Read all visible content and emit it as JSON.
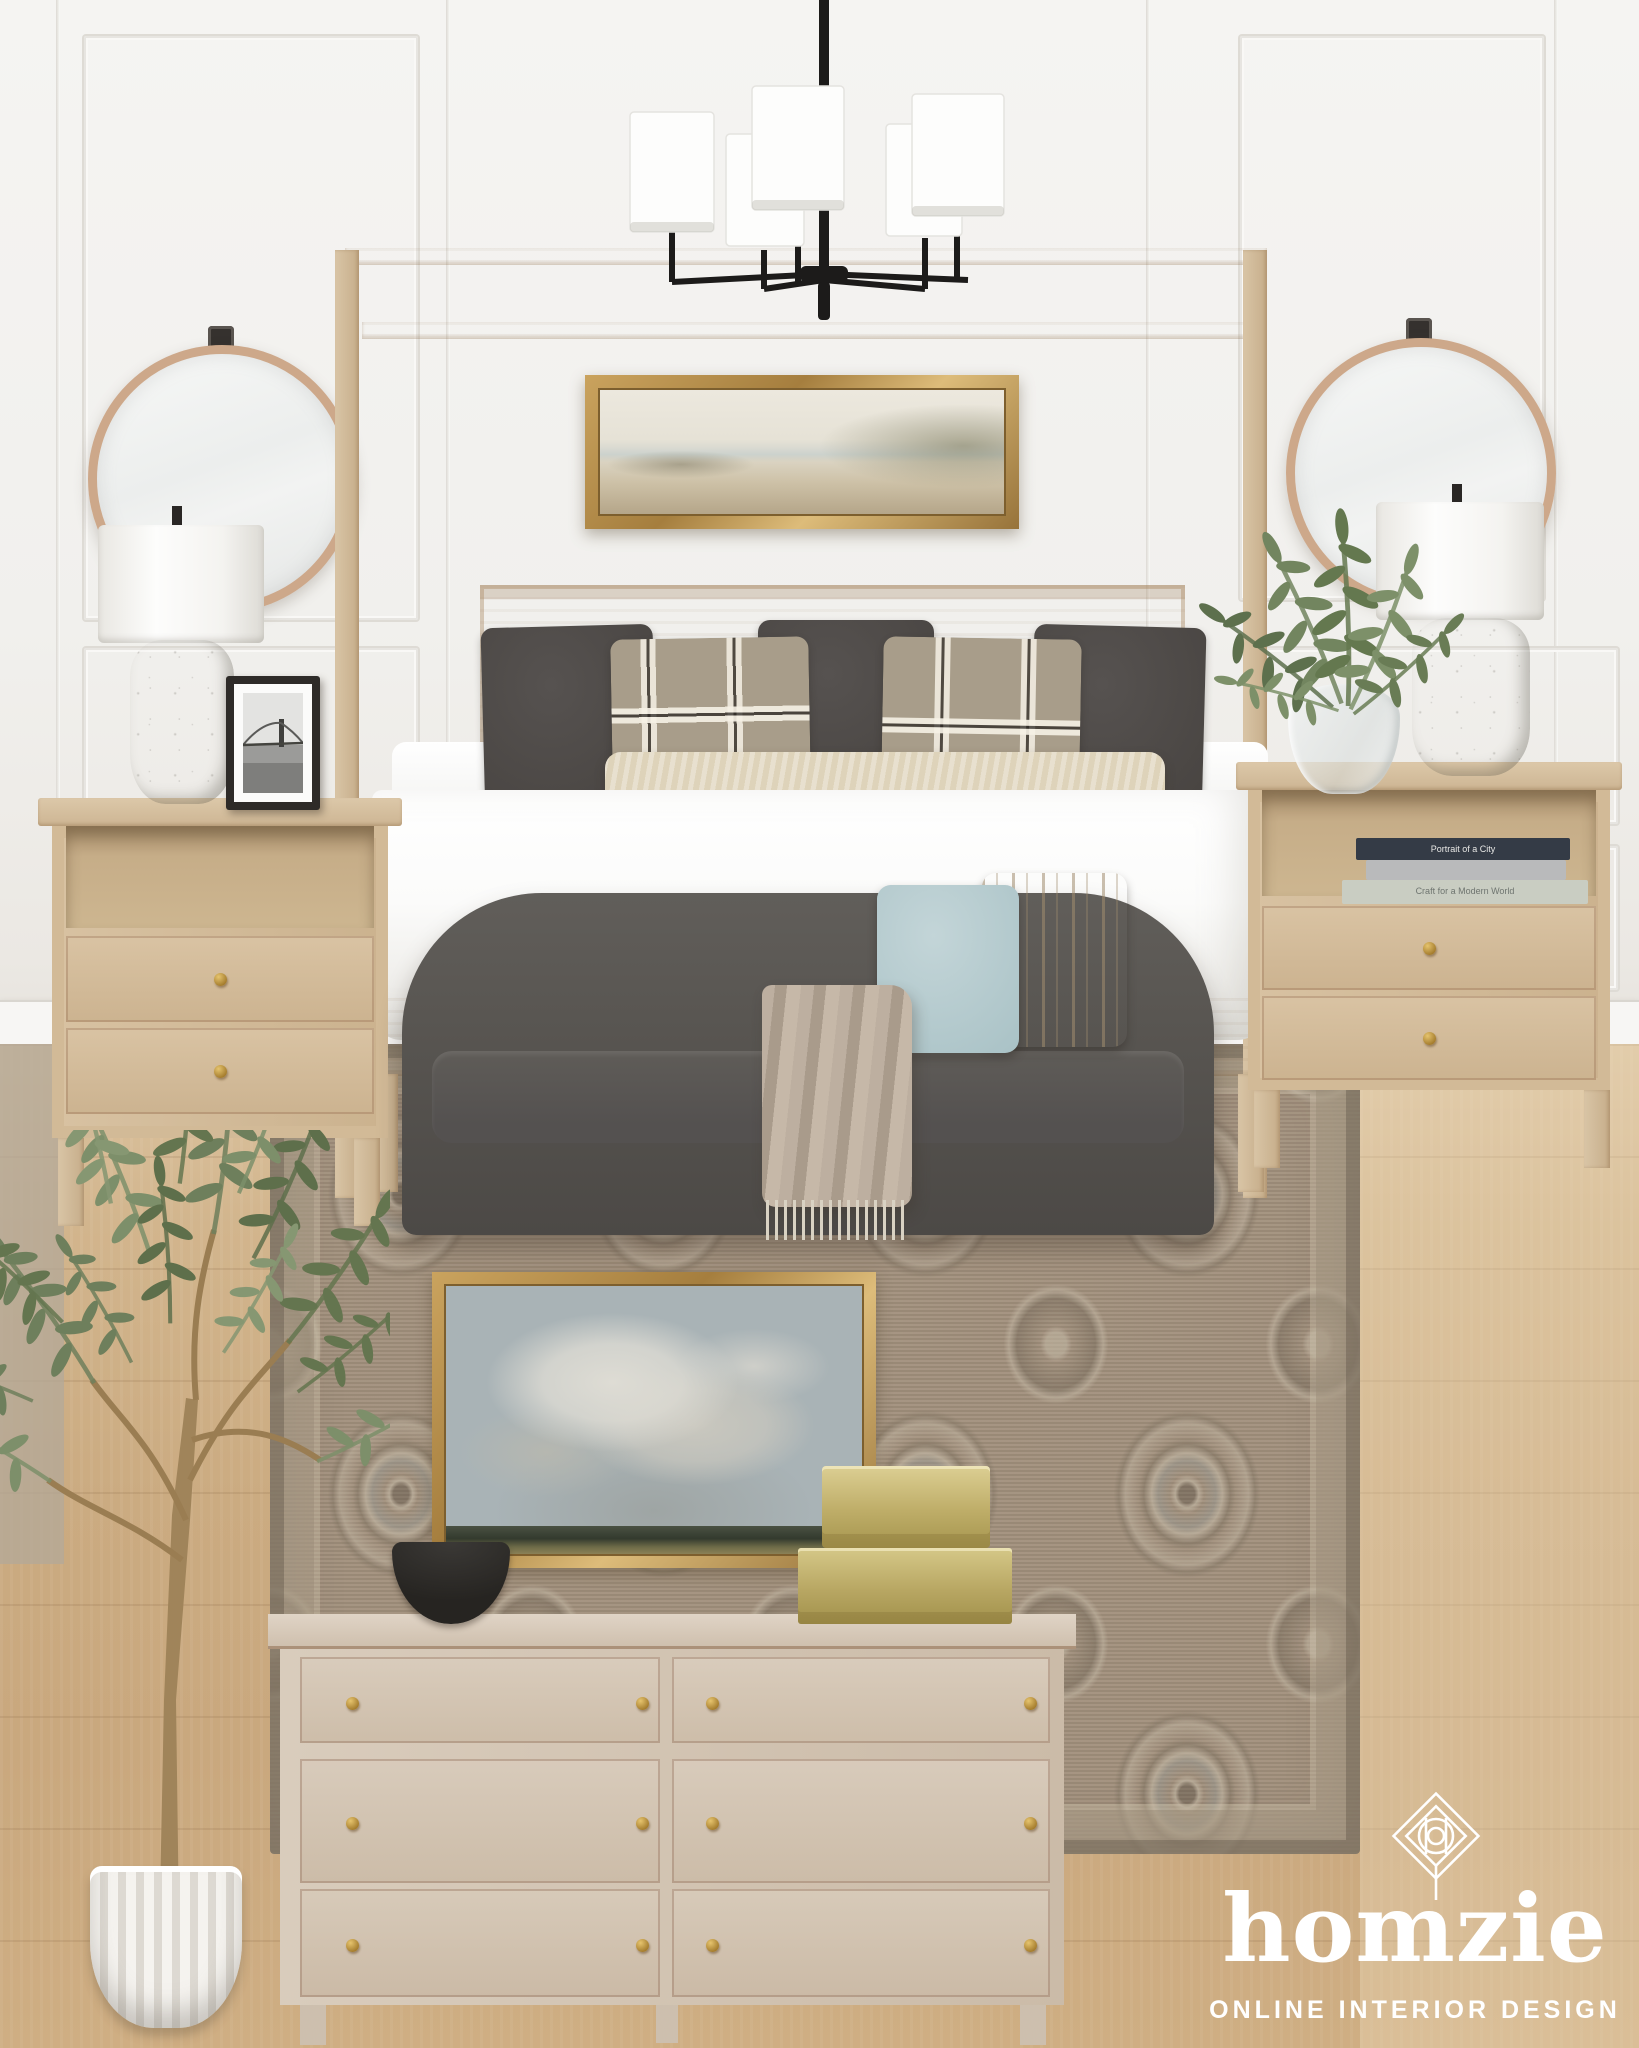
{
  "brand": {
    "name": "homzie",
    "tagline": "ONLINE INTERIOR DESIGN",
    "logo_icon": "diamond-monogram-icon",
    "text_color": "#ffffff"
  },
  "books": {
    "top_spine": "Portrait of a City",
    "bottom_spine": "Craft for a Modern World"
  },
  "palette": {
    "wall": "#f2f1ee",
    "floor_oak": "#cbab81",
    "rug_taupe": "#a08f7c",
    "bed_wood": "#d5c1a1",
    "bench_charcoal": "#54504c",
    "dark_pillow": "#4c4744",
    "plaid_pillow": "#a89d8a",
    "lumbar_pillow": "#ded3ba",
    "blue_pillow": "#b7cdd1",
    "throw_taupe": "#b4a795",
    "frame_gold": "#b2904f",
    "brass": "#c3b274",
    "stone_lamp": "#c6c1b5",
    "olive_leaf": "#6e7f5c",
    "logo_white": "#ffffff"
  },
  "items": [
    {
      "name": "chandelier",
      "desc": "black 5-light chandelier with white drum shades"
    },
    {
      "name": "canopy-bed",
      "desc": "light wood canopy bed with white bedding"
    },
    {
      "name": "beach-art",
      "desc": "gold framed coastal watercolor above bed"
    },
    {
      "name": "round-mirror-left",
      "desc": "round wood-frame mirror"
    },
    {
      "name": "round-mirror-right",
      "desc": "round wood-frame mirror"
    },
    {
      "name": "table-lamp-left",
      "desc": "stone base lamp with white drum shade"
    },
    {
      "name": "table-lamp-right",
      "desc": "stone base lamp with white drum shade"
    },
    {
      "name": "bridge-photo-frame",
      "desc": "black frame, B&W bridge photo"
    },
    {
      "name": "nightstand-left",
      "desc": "whitewashed wood nightstand"
    },
    {
      "name": "nightstand-right",
      "desc": "whitewashed wood nightstand with books"
    },
    {
      "name": "vase-greenery",
      "desc": "glass vase with green branches"
    },
    {
      "name": "upholstered-bench",
      "desc": "charcoal tub bench with pillows and throw"
    },
    {
      "name": "vintage-rug",
      "desc": "taupe persian-style rug"
    },
    {
      "name": "cloud-art",
      "desc": "gold framed cloud painting"
    },
    {
      "name": "black-bowl",
      "desc": "black footed bowl"
    },
    {
      "name": "brass-boxes",
      "desc": "stacked brass boxes"
    },
    {
      "name": "dresser",
      "desc": "whitewashed 6-drawer dresser with brass knobs"
    },
    {
      "name": "olive-tree",
      "desc": "faux olive tree in white ribbed planter"
    }
  ]
}
